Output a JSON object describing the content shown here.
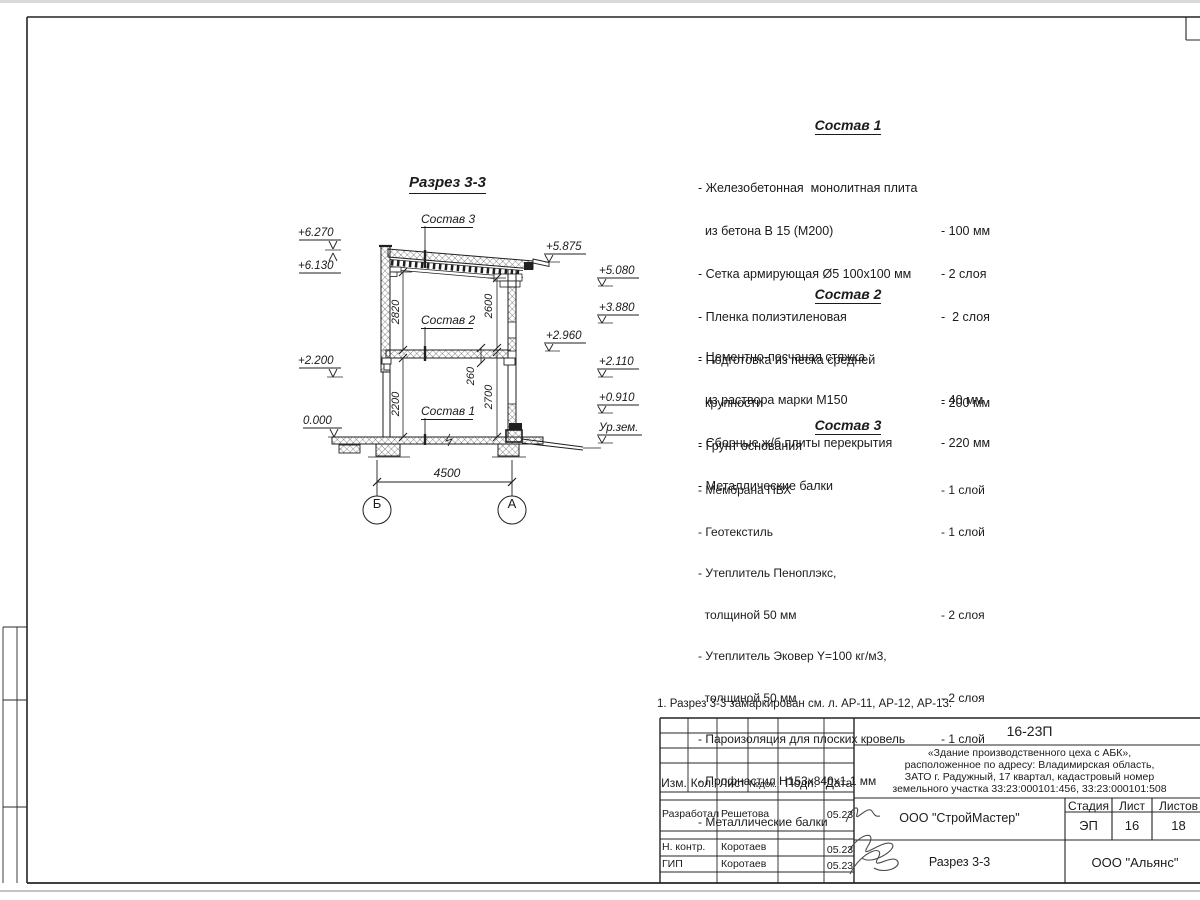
{
  "page": {
    "note": "1. Разрез 3-3 замаркирован см. л. АР-11, АР-12, АР-13."
  },
  "drawing": {
    "title": "Разрез 3-3",
    "callouts": {
      "c3": "Состав 3",
      "c2": "Состав 2",
      "c1": "Состав 1"
    },
    "elev": {
      "p6270": "+6.270",
      "p6130": "+6.130",
      "p2200": "+2.200",
      "p0000": "0.000",
      "p5875": "+5.875",
      "p5080": "+5.080",
      "p3880": "+3.880",
      "p2960": "+2.960",
      "p2110": "+2.110",
      "p0910": "+0.910",
      "ground": "Ур.зем."
    },
    "dims": {
      "h_left_up": "2820",
      "h_right_up": "2600",
      "h_left_low": "2200",
      "slab": "260",
      "h_right_low": "2700",
      "span": "4500"
    },
    "axes": {
      "b": "Б",
      "a": "А"
    }
  },
  "sostav1": {
    "title": "Состав 1",
    "lines": [
      {
        "t": "- Железобетонная  монолитная плита",
        "v": ""
      },
      {
        "t": "  из бетона В 15 (М200)",
        "v": "- 100 мм"
      },
      {
        "t": "- Сетка армирующая Ø5 100х100 мм",
        "v": "- 2 слоя"
      },
      {
        "t": "- Пленка полиэтиленовая",
        "v": "-  2 слоя"
      },
      {
        "t": "- Подготовка из песка средней",
        "v": ""
      },
      {
        "t": "  крупности",
        "v": "- 200 мм"
      },
      {
        "t": "- Грунт основания",
        "v": ""
      }
    ]
  },
  "sostav2": {
    "title": "Состав 2",
    "lines": [
      {
        "t": "- Цементно-песчаная стяжка",
        "v": ""
      },
      {
        "t": "  из раствора марки М150",
        "v": "- 40 мм"
      },
      {
        "t": "- Сборные ж/б плиты перекрытия",
        "v": "- 220 мм"
      },
      {
        "t": "- Металлические балки",
        "v": ""
      }
    ]
  },
  "sostav3": {
    "title": "Состав 3",
    "lines": [
      {
        "t": "- Мембрана ПВХ",
        "v": "- 1 слой"
      },
      {
        "t": "- Геотекстиль",
        "v": "- 1 слой"
      },
      {
        "t": "- Утеплитель Пеноплэкс,",
        "v": ""
      },
      {
        "t": "  толщиной 50 мм",
        "v": "- 2 слоя"
      },
      {
        "t": "- Утеплитель Эковер Y=100 кг/м3,",
        "v": ""
      },
      {
        "t": "  толщиной 50 мм",
        "v": "- 2 слоя"
      },
      {
        "t": "- Пароизоляция для плоских кровель",
        "v": "- 1 слой"
      },
      {
        "t": "- Профнастил Н153х840х1.1 мм",
        "v": ""
      },
      {
        "t": "- Металлические балки",
        "v": ""
      }
    ]
  },
  "titleblock": {
    "doc_number": "16-23П",
    "project": [
      "«Здание производственного цеха с АБК»,",
      "расположенное по адресу: Владимирская область,",
      "ЗАТО г. Радужный, 17 квартал, кадастровый номер",
      "земельного участка 33:23:000101:456, 33:23:000101:508"
    ],
    "cols": {
      "izm": "Изм.",
      "kol": "Кол.",
      "list": "Лист",
      "ndok": "№док.",
      "podp": "Подп.",
      "data": "Дата"
    },
    "rows": [
      {
        "role": "Разработал",
        "name": "Решетова",
        "date": "05.23"
      },
      {
        "role": "Н. контр.",
        "name": "Коротаев",
        "date": "05.23"
      },
      {
        "role": "ГИП",
        "name": "Коротаев",
        "date": "05.23"
      }
    ],
    "contractor": "ООО \"СтройМастер\"",
    "sheet_name": "Разрез 3-3",
    "stage_label": "Стадия",
    "list_label": "Лист",
    "listov_label": "Листов",
    "stage": "ЭП",
    "sheet_no": "16",
    "sheets_total": "18",
    "client": "ООО \"Альянс\""
  }
}
